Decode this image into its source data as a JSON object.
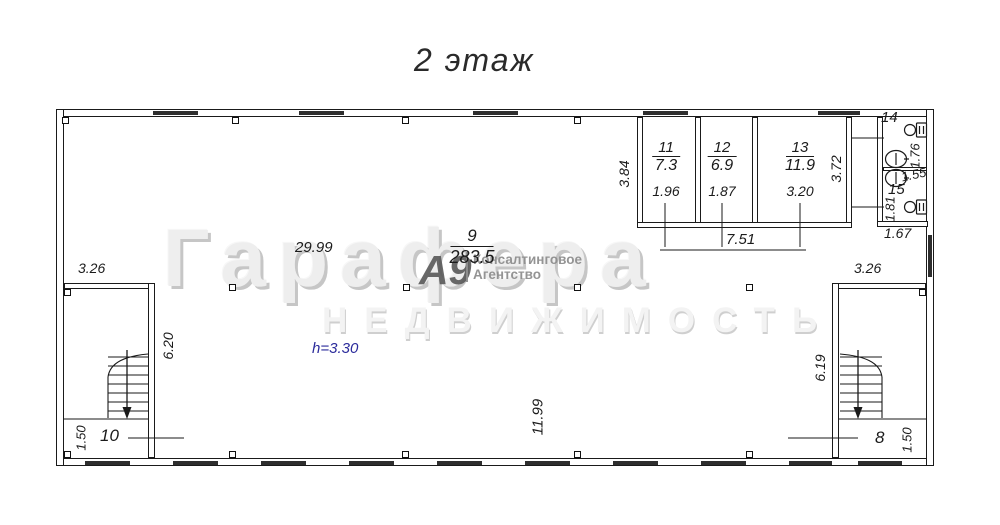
{
  "title": "2 этаж",
  "watermark": {
    "brand": "Гарафера",
    "subtitle": "НЕДВИЖИМОСТЬ",
    "logo": "А9",
    "agency_line1": "Консалтинговое",
    "agency_line2": "Агентство"
  },
  "note": {
    "ceiling_height": "h=3.30",
    "color": "#2b2b9b"
  },
  "rooms": {
    "r9": {
      "number": "9",
      "area": "283.5"
    },
    "r10": {
      "number": "10"
    },
    "r8": {
      "number": "8"
    },
    "r11": {
      "number": "11",
      "area": "7.3",
      "width": "1.96"
    },
    "r12": {
      "number": "12",
      "area": "6.9",
      "width": "1.87"
    },
    "r13": {
      "number": "13",
      "area": "11.9",
      "width": "3.20"
    },
    "r14": {
      "number": "14"
    },
    "r15": {
      "number": "15"
    }
  },
  "dimensions": {
    "hall_width": "29.99",
    "hall_depth": "11.99",
    "rooms_block_left": "3.84",
    "rooms_block_right": "3.72",
    "rooms_block_total": "7.51",
    "left_stair_width": "3.26",
    "left_stair_depth": "6.20",
    "left_stair_bottom": "1.50",
    "right_stair_width": "3.26",
    "right_stair_depth": "6.19",
    "right_stair_bottom": "1.50",
    "wc_top": "1.76",
    "wc_middle": "1.55",
    "wc_lower": "1.81",
    "wc_width": "1.67"
  }
}
